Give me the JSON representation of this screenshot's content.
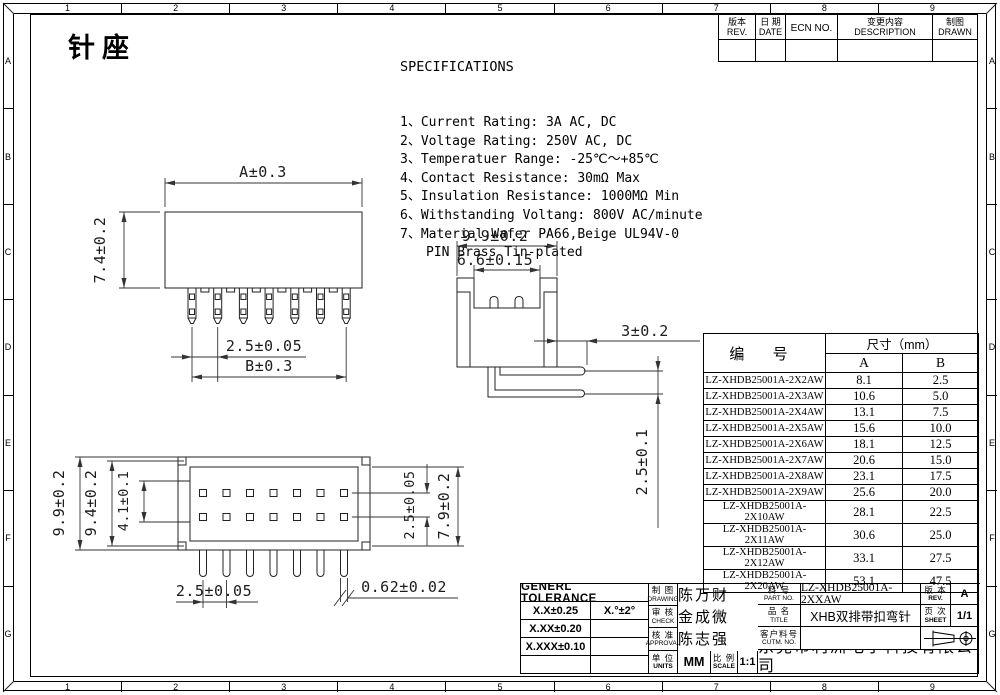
{
  "page": {
    "title": "针座"
  },
  "border": {
    "columns": [
      "1",
      "2",
      "3",
      "4",
      "5",
      "6",
      "7",
      "8",
      "9"
    ],
    "rows": [
      "A",
      "B",
      "C",
      "D",
      "E",
      "F",
      "G"
    ]
  },
  "specs": {
    "heading": "SPECIFICATIONS",
    "lines": [
      "1、Current Rating: 3A AC, DC",
      "2、Voltage Rating: 250V AC, DC",
      "3、Temperatuer Range: -25℃～+85℃",
      "4、Contact Resistance: 30mΩ Max",
      "5、Insulation Resistance: 1000MΩ Min",
      "6、Withstanding Voltang: 800V AC/minute",
      "7、Material:Wafer PA66,Beige UL94V-0",
      "PIN Brass Tin-plated"
    ]
  },
  "revision_table": {
    "headers": [
      {
        "zh": "版本",
        "en": "REV."
      },
      {
        "zh": "日 期",
        "en": "DATE"
      },
      {
        "zh": "",
        "en": "ECN NO."
      },
      {
        "zh": "变更内容",
        "en": "DESCRIPTION"
      },
      {
        "zh": "制图",
        "en": "DRAWN"
      }
    ]
  },
  "parts_table": {
    "part_col_header": "编 号",
    "size_header": "尺寸（mm）",
    "sub_headers": [
      "A",
      "B"
    ],
    "rows": [
      {
        "part_no": "LZ-XHDB25001A-2X2AW",
        "a": "8.1",
        "b": "2.5"
      },
      {
        "part_no": "LZ-XHDB25001A-2X3AW",
        "a": "10.6",
        "b": "5.0"
      },
      {
        "part_no": "LZ-XHDB25001A-2X4AW",
        "a": "13.1",
        "b": "7.5"
      },
      {
        "part_no": "LZ-XHDB25001A-2X5AW",
        "a": "15.6",
        "b": "10.0"
      },
      {
        "part_no": "LZ-XHDB25001A-2X6AW",
        "a": "18.1",
        "b": "12.5"
      },
      {
        "part_no": "LZ-XHDB25001A-2X7AW",
        "a": "20.6",
        "b": "15.0"
      },
      {
        "part_no": "LZ-XHDB25001A-2X8AW",
        "a": "23.1",
        "b": "17.5"
      },
      {
        "part_no": "LZ-XHDB25001A-2X9AW",
        "a": "25.6",
        "b": "20.0"
      },
      {
        "part_no": "LZ-XHDB25001A-2X10AW",
        "a": "28.1",
        "b": "22.5"
      },
      {
        "part_no": "LZ-XHDB25001A-2X11AW",
        "a": "30.6",
        "b": "25.0"
      },
      {
        "part_no": "LZ-XHDB25001A-2X12AW",
        "a": "33.1",
        "b": "27.5"
      },
      {
        "part_no": "LZ-XHDB25001A-2X20AW",
        "a": "53.1",
        "b": "47.5"
      }
    ]
  },
  "drawings": {
    "front_view": {
      "width": "A±0.3",
      "height": "7.4±0.2",
      "pitch": "2.5±0.05",
      "span": "B±0.3"
    },
    "side_view": {
      "width": "9.9±0.2",
      "slot_width": "6.6±0.15",
      "pin_offset": "3±0.2",
      "row_pitch": "2.5±0.1"
    },
    "top_view": {
      "outer_width": "9.9±0.2",
      "inner_width": "9.4±0.2",
      "latch": "4.1±0.1",
      "pin_pitch": "2.5±0.05",
      "row_pitch": "2.5±0.05",
      "depth": "7.9±0.2",
      "pin_size": "0.62±0.02"
    }
  },
  "title_block": {
    "tolerance": {
      "heading": "GENERL TOLERANCE",
      "rows": [
        [
          "X.X±0.25",
          "X.°±2°"
        ],
        [
          "X.XX±0.20",
          ""
        ],
        [
          "X.XXX±0.10",
          ""
        ],
        [
          "",
          ""
        ]
      ]
    },
    "signoff": [
      {
        "zh": "制 图",
        "en": "DRAWING",
        "name": "陈万财"
      },
      {
        "zh": "审 核",
        "en": "CHECK",
        "name": "金成微"
      },
      {
        "zh": "核 准",
        "en": "APPROVAL",
        "name": "陈志强"
      }
    ],
    "units": {
      "zh": "单 位",
      "en": "UNITS",
      "value": "MM"
    },
    "scale": {
      "zh": "比 例",
      "en": "SCALE",
      "value": "1:1"
    },
    "part_no": {
      "zh": "料 号",
      "en": "PART NO.",
      "value": "LZ-XHDB25001A-2XXAW"
    },
    "product_name": {
      "zh": "品 名",
      "en": "TITLE",
      "value": "XHB双排带扣弯针"
    },
    "customer_no": {
      "zh": "客户料号",
      "en": "CUTM. NO.",
      "value": ""
    },
    "revision": {
      "zh": "版 本",
      "en": "REV.",
      "value": "A"
    },
    "sheet": {
      "zh": "页 次",
      "en": "SHEET",
      "value": "1/1"
    },
    "company": {
      "zh": "东莞市利洲电子科技有限公司",
      "en": "DONGGUAN LIZHOU ELECTRONIC TECHNOLOGY CO.,LID"
    }
  }
}
